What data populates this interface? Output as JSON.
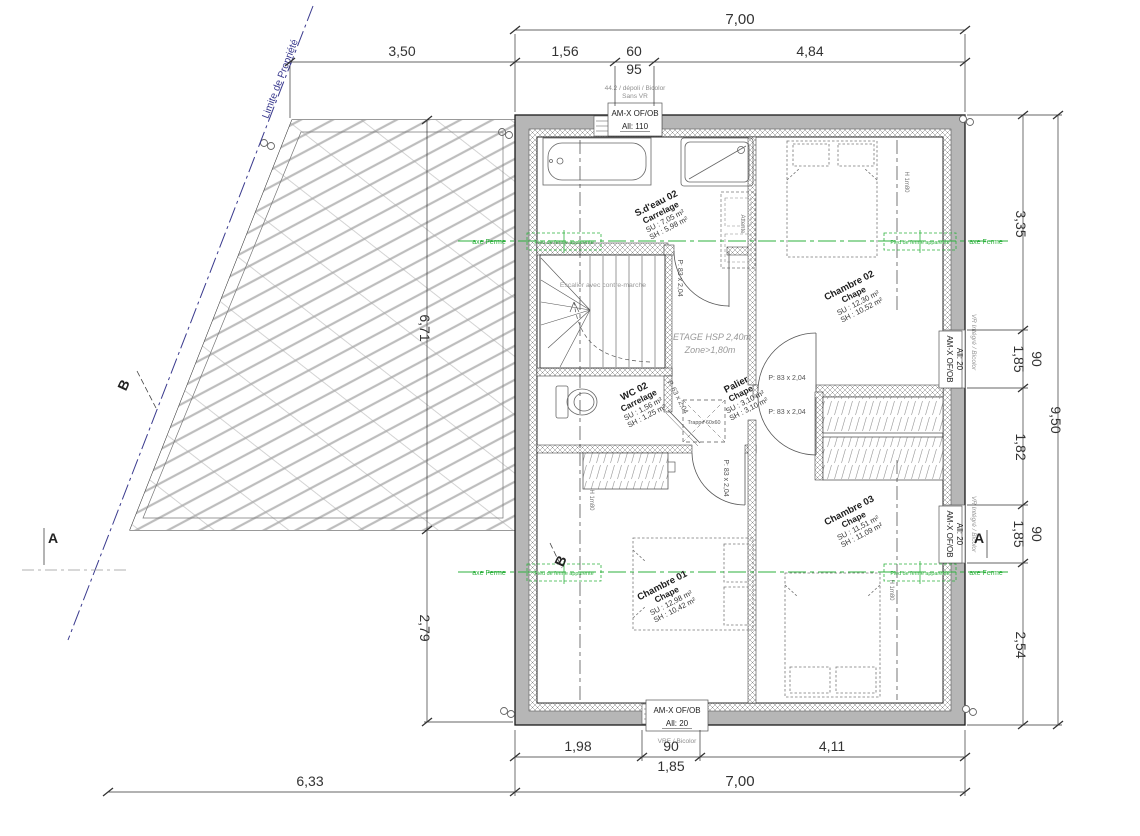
{
  "drawing": {
    "colors": {
      "green": "#2db13d",
      "blue": "#3a3a8e",
      "wall_gray": "#b6b6b6"
    }
  },
  "dims": {
    "top": {
      "d700": "7,00",
      "d350": "3,50",
      "d156": "1,56",
      "d60": "60",
      "d95": "95",
      "d484": "4,84"
    },
    "bottom": {
      "d198": "1,98",
      "d90": "90",
      "d185": "1,85",
      "d411": "4,11",
      "d700": "7,00",
      "d633": "6,33"
    },
    "left": {
      "d671": "6,71",
      "d279": "2,79"
    },
    "right": {
      "d335": "3,35",
      "d90a": "90",
      "d185a": "1,85",
      "d182": "1,82",
      "d90b": "90",
      "d185b": "1,85",
      "d254": "2,54",
      "d950": "9,50"
    }
  },
  "rooms": {
    "sdeau": {
      "name": "S.d'eau 02",
      "finish": "Carrelage",
      "su": "SU : 7,05 m²",
      "sh": "SH : 5,98 m²"
    },
    "ch02": {
      "name": "Chambre 02",
      "finish": "Chape",
      "su": "SU : 12,30 m²",
      "sh": "SH : 10,52 m²"
    },
    "palier": {
      "name": "Palier",
      "finish": "Chape",
      "su": "SU : 3,10 m²",
      "sh": "SH : 3,10 m²"
    },
    "wc02": {
      "name": "WC 02",
      "finish": "Carrelage",
      "su": "SU : 1,56 m²",
      "sh": "SH : 1,25 m²"
    },
    "ch03": {
      "name": "Chambre 03",
      "finish": "Chape",
      "su": "SU : 11,51 m²",
      "sh": "SH : 11,09 m²"
    },
    "ch01": {
      "name": "Chambre 01",
      "finish": "Chape",
      "su": "SU : 12,98 m²",
      "sh": "SH : 10,42 m²"
    }
  },
  "windows": {
    "top": {
      "note1": "44.2 / dépoli / Bicolor",
      "note2": "Sans VR",
      "label": "AM-X OF/OB",
      "allege": "All: 110"
    },
    "bottom": {
      "label": "AM-X OF/OB",
      "allege": "All: 20",
      "note": "VRE / Bicolor"
    },
    "right_upper": {
      "label": "AM-X OF/OB",
      "allege": "All: 20",
      "note": "VR Intégré / Bicolor"
    },
    "right_lower": {
      "label": "AM-X OF/OB",
      "allege": "All: 20",
      "note": "VR Intégré / Bicolor"
    }
  },
  "ann": {
    "etage": "ETAGE HSP 2,40m",
    "zone": "Zone>1,80m",
    "stairs": "Escalier avec contre-marche",
    "trappe": "Trappe 60x60",
    "door": "P: 83 x 2,04",
    "door_wc": "P. 63 x 2,04",
    "attente": "Attente",
    "h180": "H 1m80",
    "limite": "Limite de Propriété",
    "axe": "axe Ferme",
    "pied": "Pied de ferme apparente",
    "sectionA": "A",
    "sectionB": "B"
  }
}
